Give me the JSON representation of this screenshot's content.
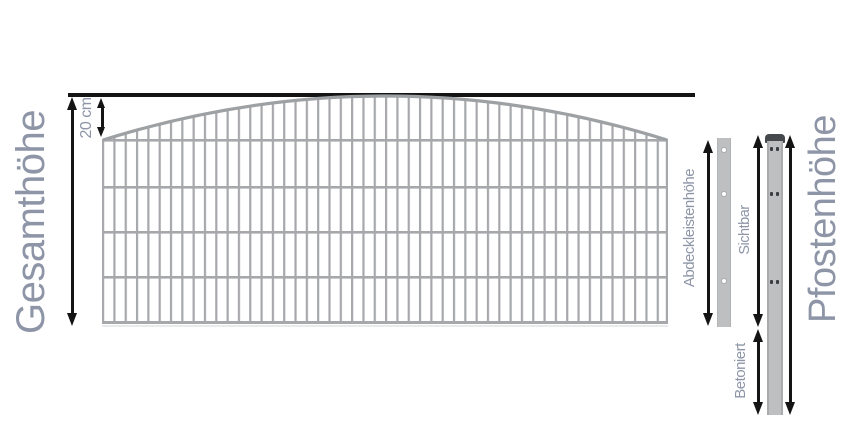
{
  "labels": {
    "gesamthoehe": "Gesamthöhe",
    "arch_rise": "20 cm",
    "abdeckleistenhoehe": "Abdeckleistenhöhe",
    "sichtbar": "Sichtbar",
    "betoniert": "Betoniert",
    "pfostenhoehe": "Pfostenhöhe"
  },
  "diagram": {
    "type": "fence-panel-dimension-diagram",
    "fence_panel": {
      "top_shape": "arch",
      "arch_rise_label": "20 cm",
      "horizontal_wire_rows": 5
    },
    "cover_strip": {
      "holes": 3
    },
    "post": {
      "has_cap": true,
      "mounting_hole_pairs": 3
    }
  },
  "colors": {
    "label_text": "#8d95a7",
    "dimension_lines": "#141414",
    "mesh_wire": "#a6a8ab",
    "arch_rail": "#9ea1a4",
    "cover_strip_fill": "#bdbfc1",
    "post_fill": "#bdbfc1",
    "post_cap": "#45494e",
    "background": "#ffffff"
  }
}
